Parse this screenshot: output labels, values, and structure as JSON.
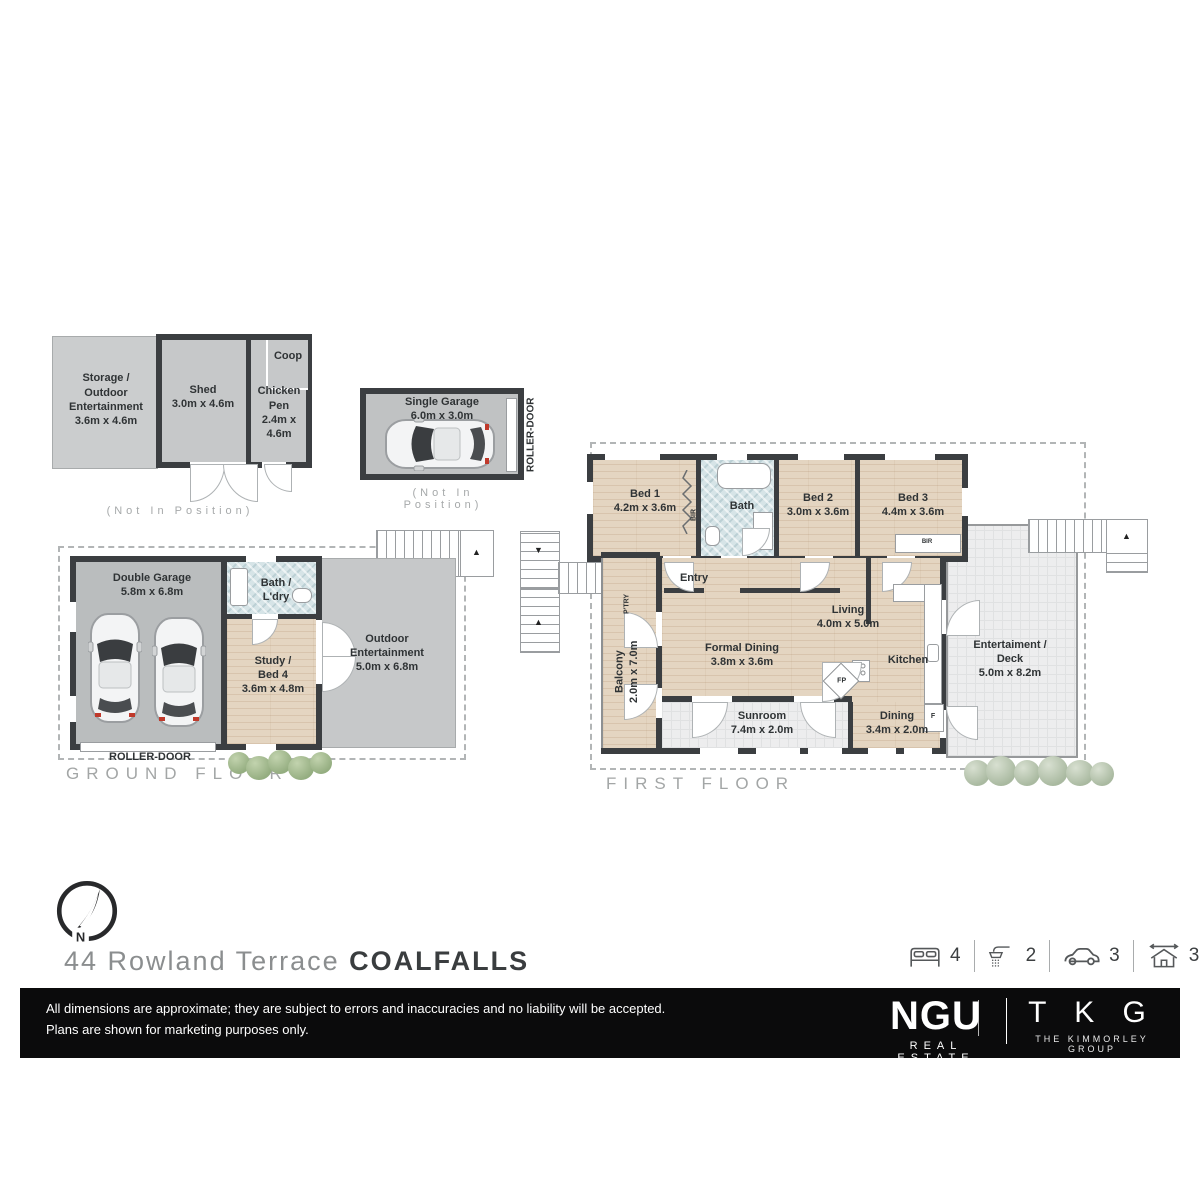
{
  "outbuilding": {
    "storage_label": "Storage /\nOutdoor\nEntertainment\n3.6m x 4.6m",
    "shed_label": "Shed\n3.0m x 4.6m",
    "chicken_label": "Chicken\nPen\n2.4m x 4.6m",
    "coop_label": "Coop",
    "note": "(Not In Position)"
  },
  "single_garage": {
    "label": "Single Garage\n6.0m x 3.0m",
    "roller_door": "ROLLER-DOOR",
    "note": "(Not In Position)"
  },
  "ground_floor": {
    "title": "GROUND FLOOR",
    "double_garage": "Double Garage\n5.8m x 6.8m",
    "bath_ldry": "Bath /\nL'dry",
    "study": "Study /\nBed 4\n3.6m x 4.8m",
    "outdoor": "Outdoor\nEntertainment\n5.0m x 6.8m",
    "roller_door": "ROLLER-DOOR"
  },
  "first_floor": {
    "title": "FIRST FLOOR",
    "bed1": "Bed 1\n4.2m x 3.6m",
    "bath": "Bath",
    "bed2": "Bed 2\n3.0m x 3.6m",
    "bed3": "Bed 3\n4.4m x 3.6m",
    "entry": "Entry",
    "balcony": "Balcony\n2.0m x 7.0m",
    "pantry": "P'TRY",
    "bir": "BIR",
    "bir2": "BIR",
    "formal_dining": "Formal Dining\n3.8m x 3.6m",
    "living": "Living\n4.0m x 5.0m",
    "kitchen": "Kitchen",
    "fireplace": "FP",
    "fridge": "F",
    "sunroom": "Sunroom\n7.4m x 2.0m",
    "dining": "Dining\n3.4m x 2.0m",
    "deck": "Entertaiment /\nDeck\n5.0m x 8.2m"
  },
  "footer": {
    "compass_n": "N",
    "address_street": "44 Rowland Terrace ",
    "address_suburb": "COALFALLS",
    "stats": [
      {
        "icon": "bed-icon",
        "value": "4"
      },
      {
        "icon": "shower-icon",
        "value": "2"
      },
      {
        "icon": "car-icon",
        "value": "3"
      },
      {
        "icon": "house-area-icon",
        "value": "338m²"
      }
    ],
    "disclaimer": "All dimensions are approximate; they are subject to errors and inaccuracies and no liability will be accepted.\nPlans are shown for marketing purposes only.",
    "ngu_name": "NGU",
    "ngu_sub": "REAL ESTATE",
    "tkg_name": "T K G",
    "tkg_sub": "THE KIMMORLEY GROUP"
  }
}
